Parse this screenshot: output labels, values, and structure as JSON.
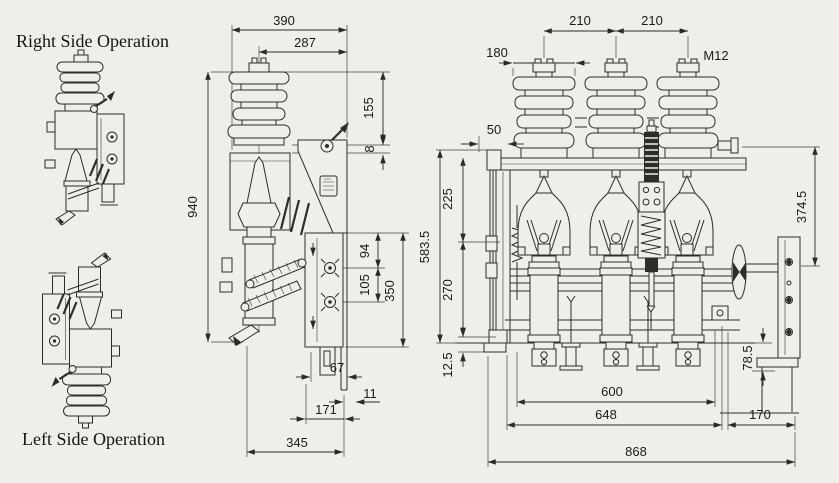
{
  "colors": {
    "background": "#f0eeea",
    "line": "#2e2c29",
    "text": "#1b1a18"
  },
  "annotations": {
    "right_side_label": "Right Side Operation",
    "left_side_label": "Left Side Operation"
  },
  "side_view": {
    "dim_width_overall": "390",
    "dim_width_center": "287",
    "dim_bushing_height": "155",
    "dim_flange_gap": "8",
    "dim_total_height": "940",
    "dim_hole_pitch_upper": "94",
    "dim_hole_pitch_lower": "105",
    "dim_plate_height": "350",
    "dim_foot_offset": "67",
    "dim_plate_thickness": "11",
    "dim_base_inner": "171",
    "dim_base_depth": "345"
  },
  "front_view": {
    "dim_pole_pitch_1": "210",
    "dim_pole_pitch_2": "210",
    "dim_insulator_dia": "180",
    "terminal_thread": "M12",
    "dim_frame_offset": "50",
    "dim_section_upper": "225",
    "dim_section_lower": "270",
    "dim_frame_height": "583.5",
    "dim_base_flange": "12.5",
    "dim_mech_height": "374.5",
    "dim_mech_offset": "78.5",
    "dim_fuse_span": "600",
    "dim_frame_width": "648",
    "dim_mech_width": "170",
    "dim_total_width": "868"
  }
}
